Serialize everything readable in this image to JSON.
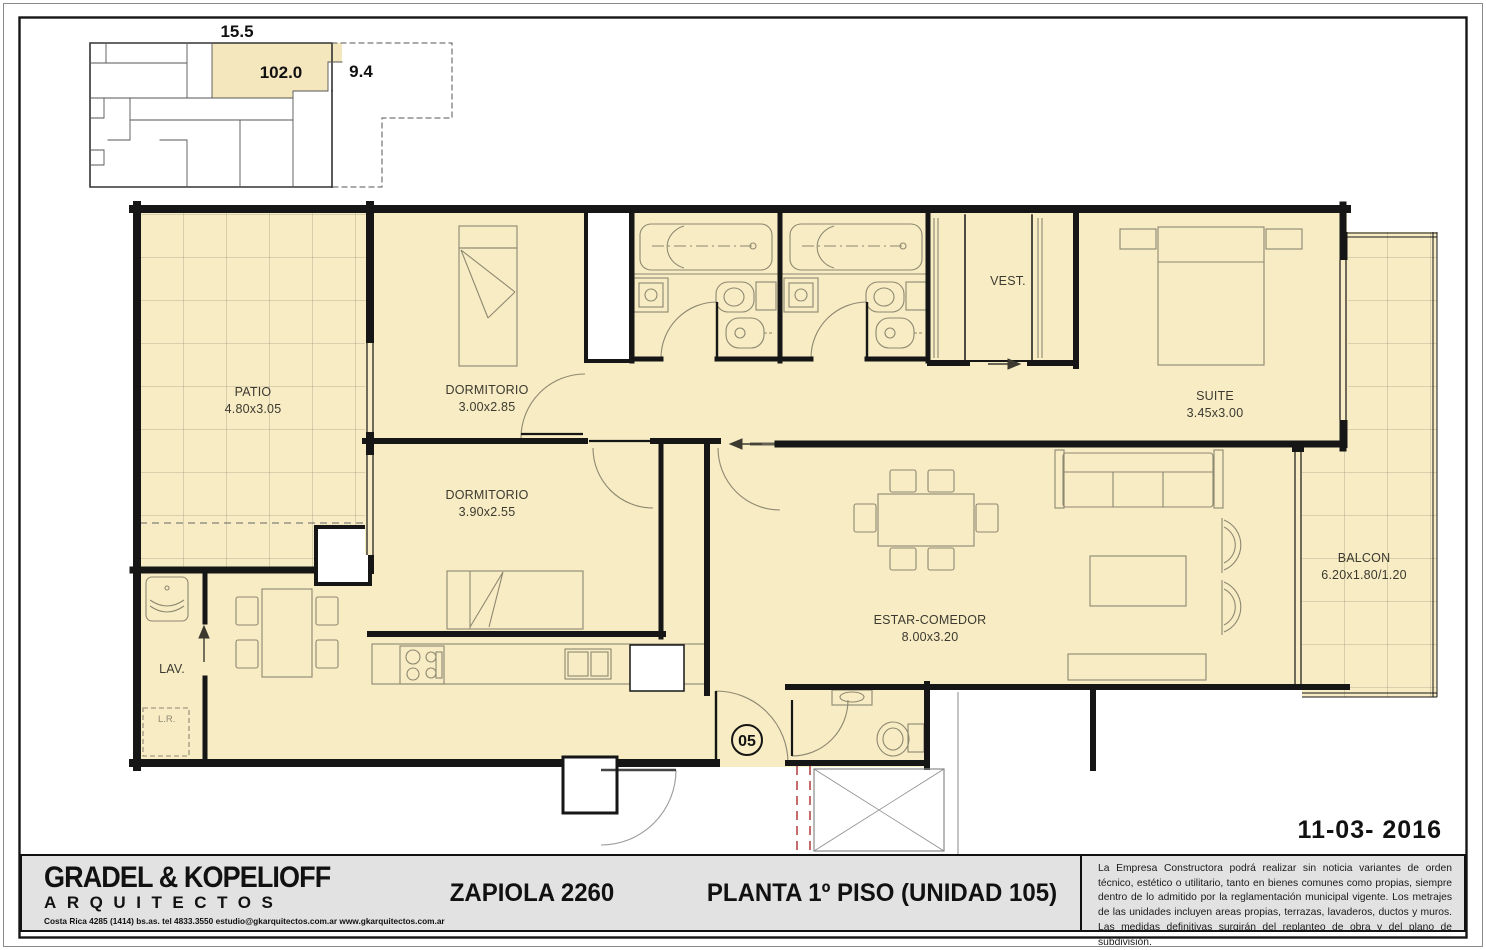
{
  "key_plan": {
    "dim_top": "15.5",
    "area_label": "102.0",
    "dim_right": "9.4"
  },
  "rooms": {
    "patio": {
      "label": "PATIO",
      "dims": "4.80x3.05"
    },
    "dormitorio1": {
      "label": "DORMITORIO",
      "dims": "3.00x2.85"
    },
    "dormitorio2": {
      "label": "DORMITORIO",
      "dims": "3.90x2.55"
    },
    "vestidor": {
      "label": "VEST."
    },
    "suite": {
      "label": "SUITE",
      "dims": "3.45x3.00"
    },
    "estar": {
      "label": "ESTAR-COMEDOR",
      "dims": "8.00x3.20"
    },
    "balcon": {
      "label": "BALCON",
      "dims": "6.20x1.80/1.20"
    },
    "lavadero": {
      "label": "LAV."
    },
    "lr": {
      "label": "L.R."
    }
  },
  "unit_number": "05",
  "title_block": {
    "firm_name": "GRADEL & KOPELIOFF",
    "firm_subtitle": "ARQUITECTOS",
    "firm_contact": "Costa Rica 4285 (1414) bs.as. tel 4833.3550 estudio@gkarquitectos.com.ar www.gkarquitectos.com.ar",
    "project_address": "ZAPIOLA 2260",
    "plan_title": "PLANTA 1º PISO (UNIDAD 105)",
    "date": "11-03- 2016",
    "disclaimer": "La Empresa Constructora podrá realizar sin noticia variantes de orden técnico, estético o utilitario, tanto en bienes comunes como propias, siempre dentro de lo admitido por la reglamentación municipal vigente. Los metrajes de las unidades incluyen areas propias, terrazas, lavaderos, ductos y muros. Las medidas definitivas surgirán del replanteo de obra y del plano de subdivisión."
  },
  "colors": {
    "unit_fill": "#f7ecc4",
    "wall": "#161616",
    "furniture_line": "#8d8870",
    "grid_line": "#a49f85",
    "title_bar_bg": "#e2e2e2",
    "elevator_dash": "#b23a3a"
  }
}
